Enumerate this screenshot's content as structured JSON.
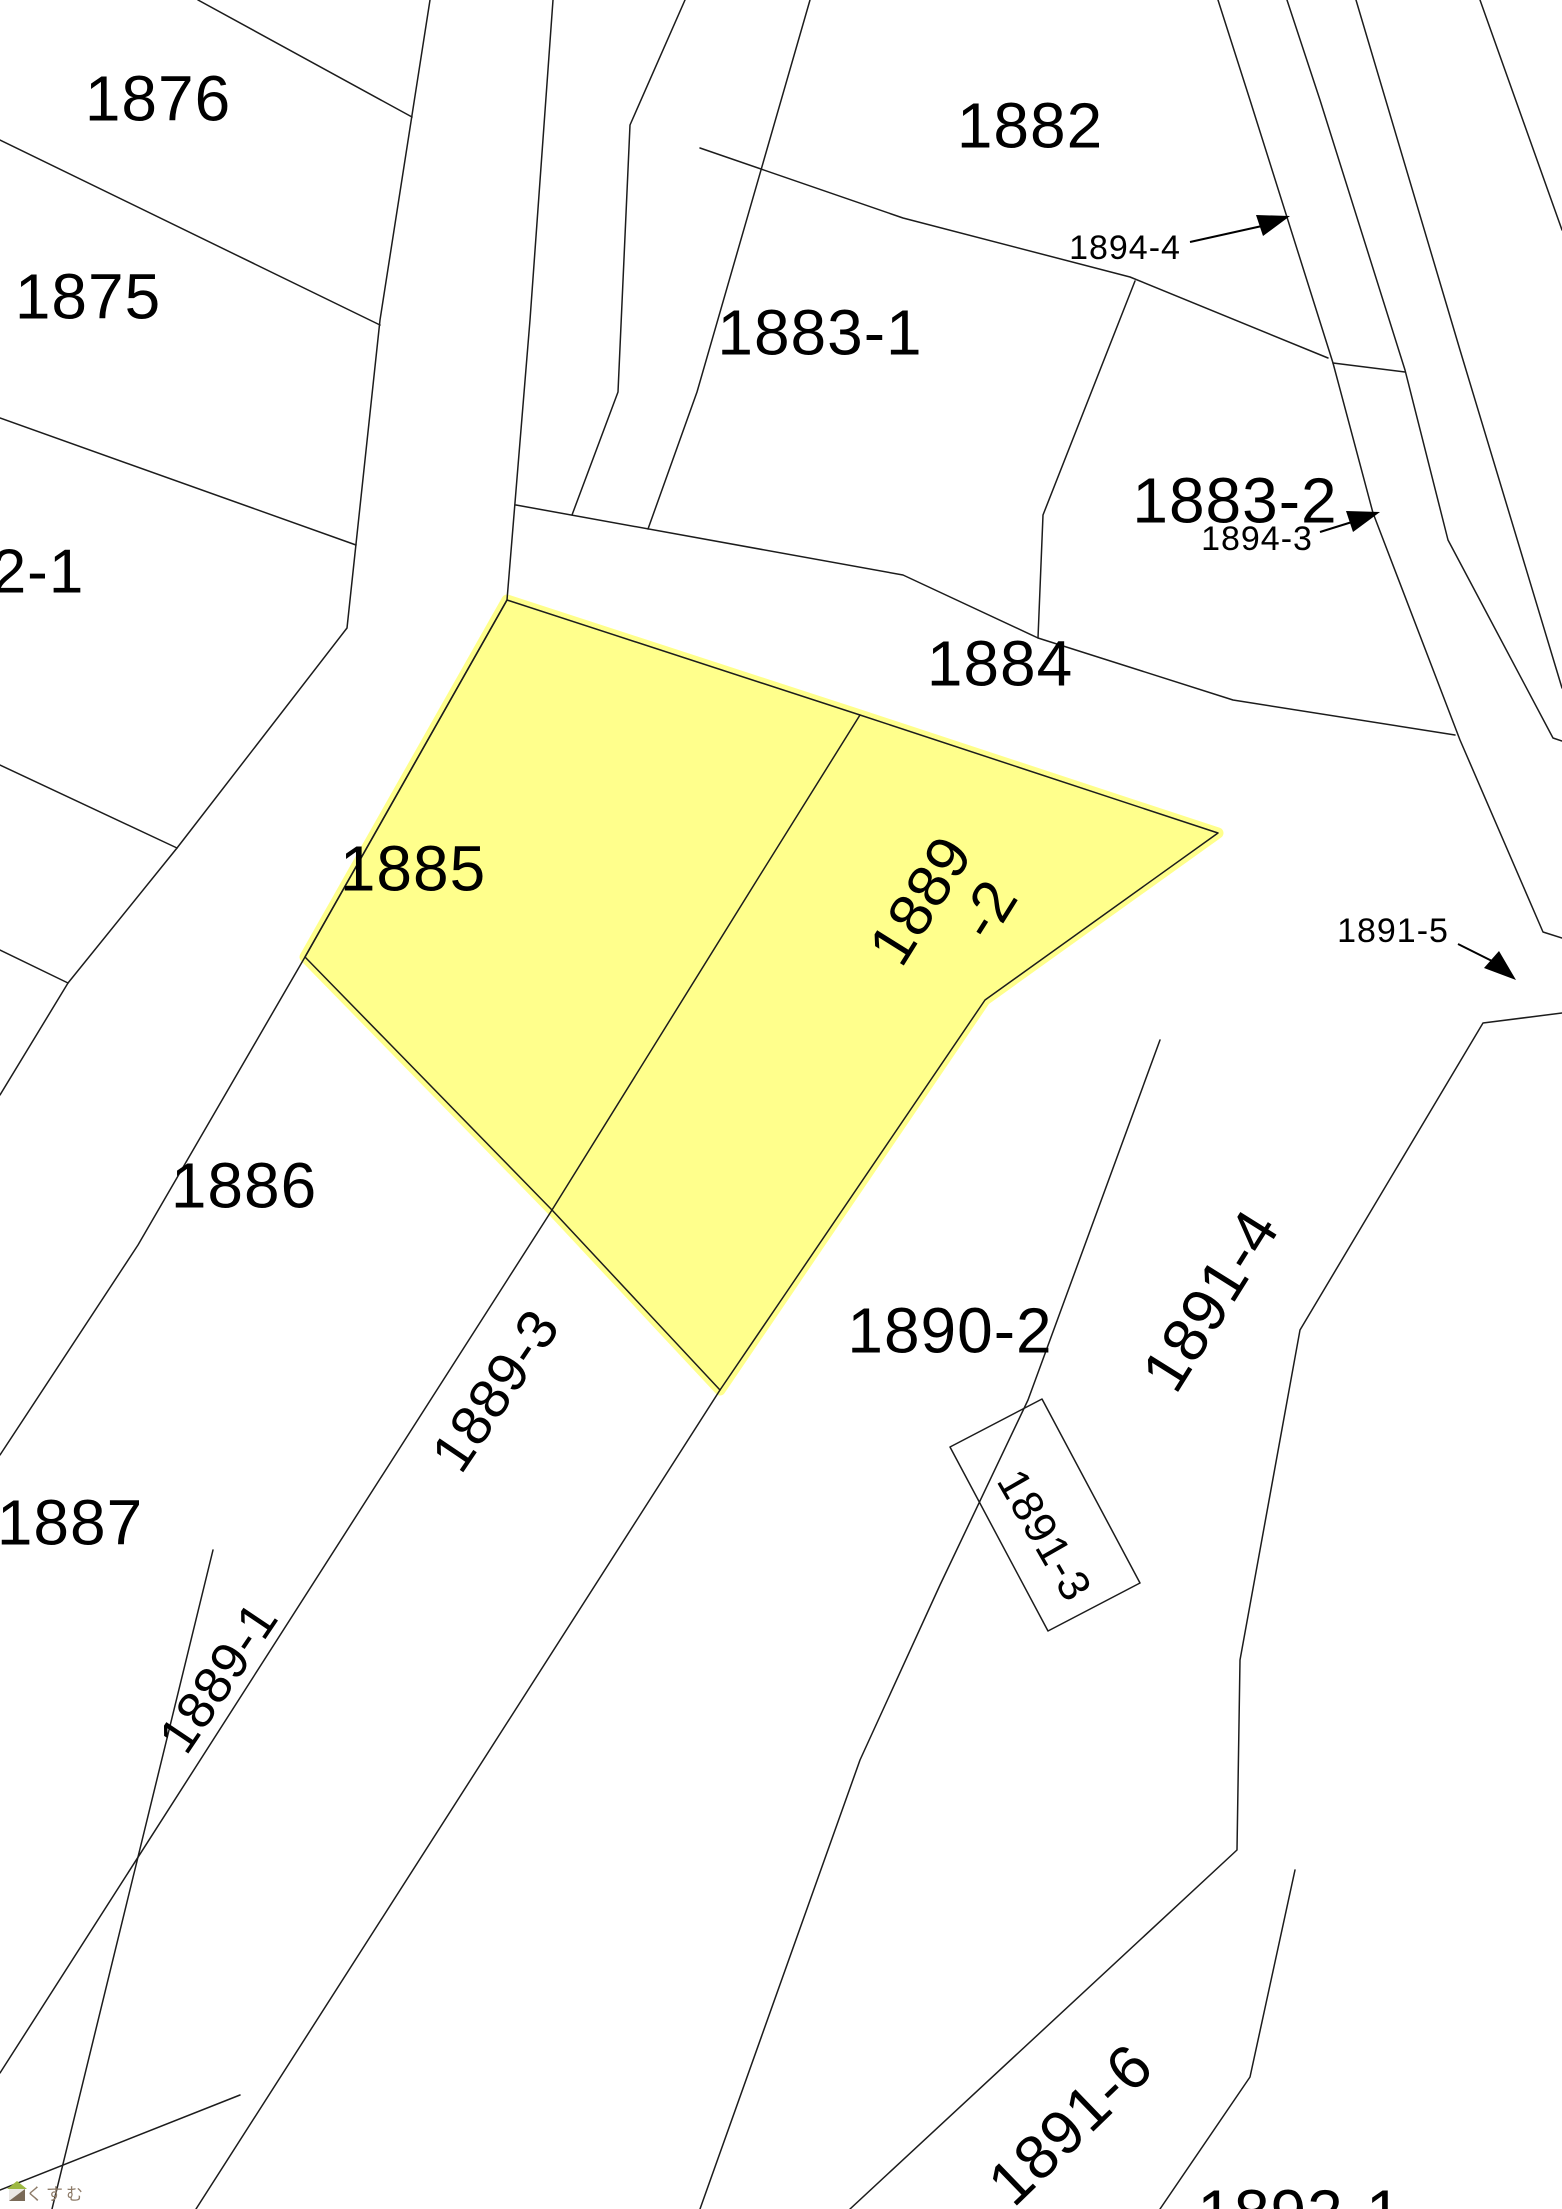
{
  "map": {
    "background": "#ffffff",
    "boundary_line_color": "#1c1c1c",
    "highlight_color": "#ffff8c",
    "highlighted_parcels": [
      "1885",
      "1889-2"
    ],
    "labels": [
      {
        "id": "1876",
        "text": "1876",
        "x": 158,
        "y": 98,
        "size": 64,
        "rotate": 0
      },
      {
        "id": "1875",
        "text": "1875",
        "x": 88,
        "y": 296,
        "size": 64,
        "rotate": 0
      },
      {
        "id": "2-1",
        "text": "2-1",
        "x": 38,
        "y": 571,
        "size": 62,
        "rotate": 0
      },
      {
        "id": "1882",
        "text": "1882",
        "x": 1030,
        "y": 125,
        "size": 64,
        "rotate": 0
      },
      {
        "id": "1883-1",
        "text": "1883-1",
        "x": 820,
        "y": 332,
        "size": 64,
        "rotate": 0
      },
      {
        "id": "1883-2",
        "text": "1883-2",
        "x": 1235,
        "y": 500,
        "size": 64,
        "rotate": 0
      },
      {
        "id": "1884",
        "text": "1884",
        "x": 1000,
        "y": 663,
        "size": 64,
        "rotate": 0
      },
      {
        "id": "1885",
        "text": "1885",
        "x": 413,
        "y": 868,
        "size": 64,
        "rotate": 0
      },
      {
        "id": "1889-2",
        "text": "1889",
        "text2": "-2",
        "x": 920,
        "y": 900,
        "size": 60,
        "rotate": -58
      },
      {
        "id": "1886",
        "text": "1886",
        "x": 244,
        "y": 1185,
        "size": 64,
        "rotate": 0
      },
      {
        "id": "1887",
        "text": "1887",
        "x": 70,
        "y": 1522,
        "size": 64,
        "rotate": 0
      },
      {
        "id": "1889-3",
        "text": "1889-3",
        "x": 495,
        "y": 1390,
        "size": 56,
        "rotate": -56
      },
      {
        "id": "1889-1",
        "text": "1889-1",
        "x": 218,
        "y": 1677,
        "size": 52,
        "rotate": -56
      },
      {
        "id": "1890-2",
        "text": "1890-2",
        "x": 950,
        "y": 1330,
        "size": 64,
        "rotate": 0
      },
      {
        "id": "1891-4",
        "text": "1891-4",
        "x": 1210,
        "y": 1300,
        "size": 62,
        "rotate": -58
      },
      {
        "id": "1891-3",
        "text": "1891-3",
        "x": 1045,
        "y": 1535,
        "size": 44,
        "rotate": 60
      },
      {
        "id": "1891-5",
        "text": "1891-5",
        "x": 1393,
        "y": 930,
        "size": 34,
        "rotate": 0
      },
      {
        "id": "1894-4",
        "text": "1894-4",
        "x": 1125,
        "y": 247,
        "size": 34,
        "rotate": 0
      },
      {
        "id": "1894-3",
        "text": "1894-3",
        "x": 1257,
        "y": 538,
        "size": 34,
        "rotate": 0
      },
      {
        "id": "1891-6",
        "text": "1891-6",
        "x": 1070,
        "y": 2124,
        "size": 62,
        "rotate": -44
      },
      {
        "id": "1892-1",
        "text": "1892-1",
        "x": 1300,
        "y": 2212,
        "size": 64,
        "rotate": 0
      }
    ],
    "arrow_annotations": [
      "1894-4",
      "1894-3",
      "1891-5"
    ]
  },
  "logo": {
    "text": "らくすむ",
    "text_color": "#8d7b68",
    "roof_color": "#9db842",
    "body_color": "#7a6a58"
  }
}
